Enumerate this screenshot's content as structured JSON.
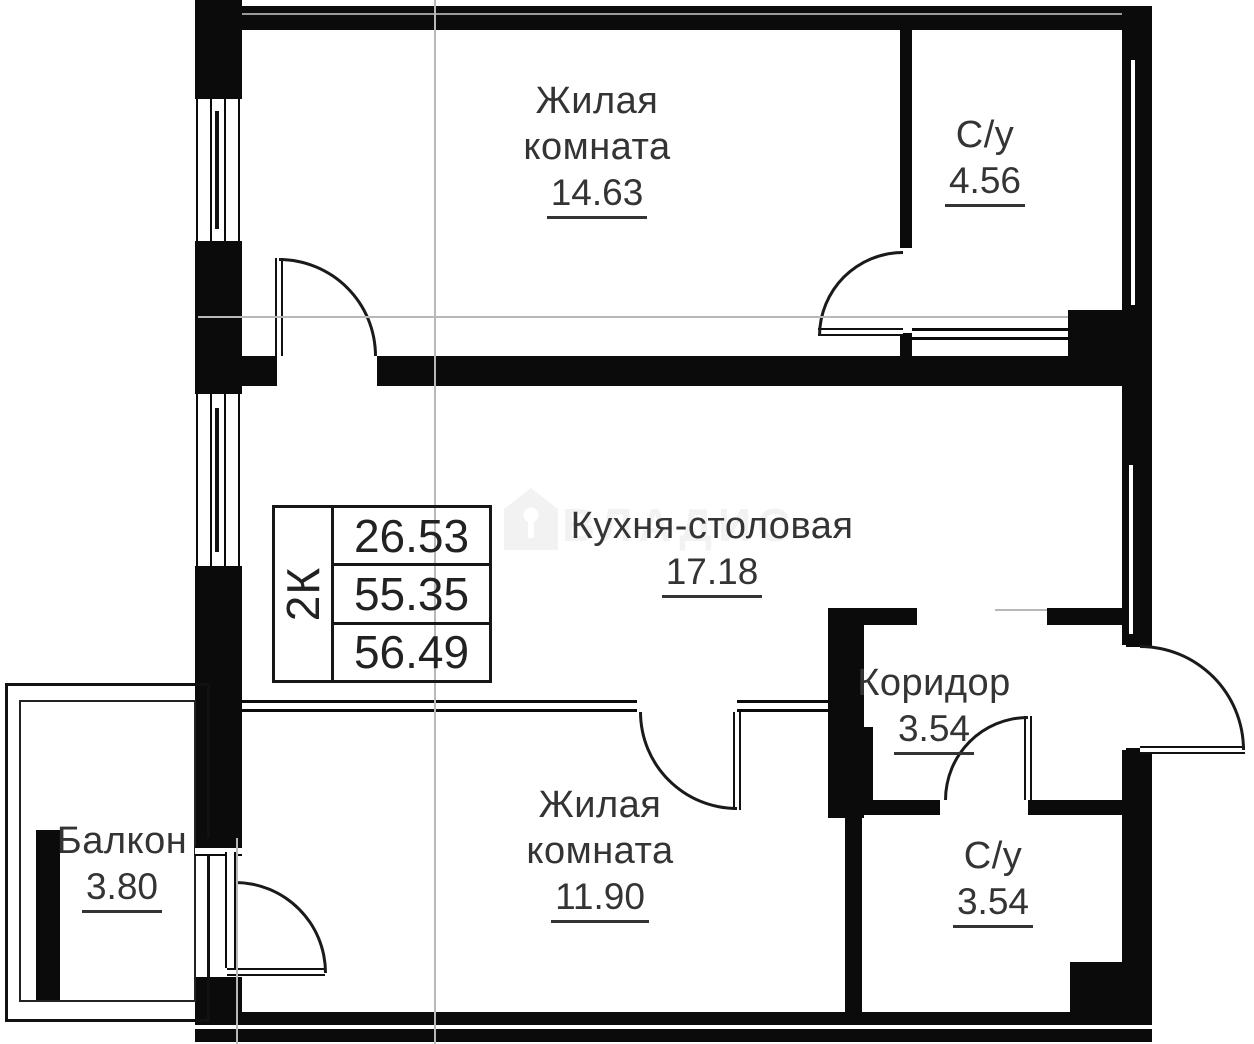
{
  "stamp": {
    "type_label": "2К",
    "rows": [
      "26.53",
      "55.35",
      "56.49"
    ]
  },
  "rooms": {
    "living_top": {
      "line1": "Жилая",
      "line2": "комната",
      "area": "14.63"
    },
    "bath_top": {
      "line1": "С/у",
      "area": "4.56"
    },
    "kitchen": {
      "line1": "Кухня-столовая",
      "area": "17.18"
    },
    "corridor": {
      "line1": "Коридор",
      "area": "3.54"
    },
    "living_bottom": {
      "line1": "Жилая",
      "line2": "комната",
      "area": "11.90"
    },
    "bath_bottom": {
      "line1": "С/у",
      "area": "3.54"
    },
    "balcony": {
      "line1": "Балкон",
      "area": "3.80"
    }
  },
  "watermark": {
    "text": "ВЛАДИС"
  },
  "colors": {
    "wall": "#0b0b0b",
    "text": "#343434",
    "axis": "#b8b8b8"
  }
}
